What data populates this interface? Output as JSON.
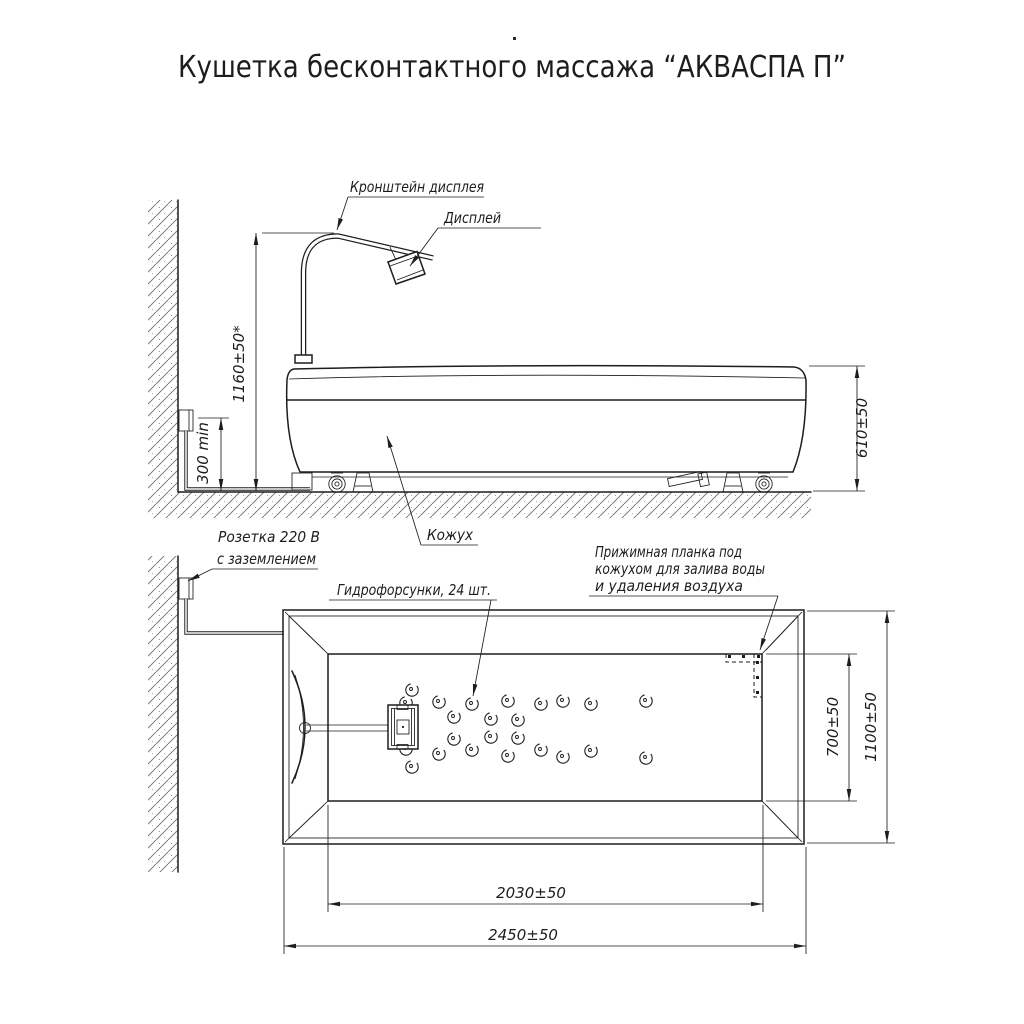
{
  "title": "Кушетка бесконтактного массажа “АКВАСПА П”",
  "side_view": {
    "bracket_label": "Кронштейн дисплея",
    "display_label": "Дисплей",
    "socket_label_line1": "Розетка 220 В",
    "socket_label_line2": "с заземлением",
    "cover_label": "Кожух",
    "dim_height_to_bracket": "1160±50*",
    "dim_socket_height": "300 min",
    "dim_couch_height": "610±50"
  },
  "top_view": {
    "nozzles_label": "Гидрофорсунки, 24 шт.",
    "nozzle_count": 24,
    "clamp_label_line1": "Прижимная планка под",
    "clamp_label_line2": "кожухом для залива воды",
    "clamp_label_line3": "и удаления воздуха",
    "dim_inner_length": "2030±50",
    "dim_outer_length": "2450±50",
    "dim_inner_width": "700±50",
    "dim_outer_width": "1100±50",
    "nozzle_positions": [
      [
        412,
        690
      ],
      [
        406,
        703
      ],
      [
        406,
        749
      ],
      [
        412,
        767
      ],
      [
        439,
        702
      ],
      [
        439,
        754
      ],
      [
        454,
        717
      ],
      [
        454,
        739
      ],
      [
        472,
        704
      ],
      [
        472,
        750
      ],
      [
        491,
        719
      ],
      [
        491,
        737
      ],
      [
        508,
        701
      ],
      [
        508,
        756
      ],
      [
        518,
        720
      ],
      [
        518,
        738
      ],
      [
        541,
        704
      ],
      [
        541,
        750
      ],
      [
        563,
        701
      ],
      [
        563,
        757
      ],
      [
        591,
        704
      ],
      [
        591,
        751
      ],
      [
        646,
        701
      ],
      [
        646,
        758
      ]
    ]
  },
  "colors": {
    "ink": "#1d1d1d",
    "background": "#ffffff",
    "hatch": "#6e6e6e"
  }
}
